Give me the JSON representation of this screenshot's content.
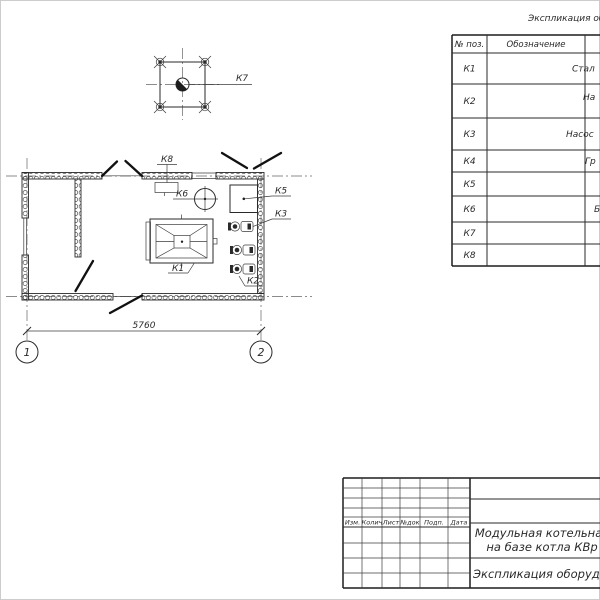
{
  "spec_table": {
    "title_fragment": "Экспликация обор",
    "col_pos": "№ поз.",
    "col_designation": "Обозначение",
    "rows": [
      {
        "pos": "К1",
        "name_fragment": "Стал"
      },
      {
        "pos": "К2",
        "name_fragment": "На"
      },
      {
        "pos": "К3",
        "name_fragment": "Насос"
      },
      {
        "pos": "К4",
        "name_fragment": "Гр"
      },
      {
        "pos": "К5",
        "name_fragment": ""
      },
      {
        "pos": "К6",
        "name_fragment": "Б"
      },
      {
        "pos": "К7",
        "name_fragment": ""
      },
      {
        "pos": "К8",
        "name_fragment": ""
      }
    ]
  },
  "plan": {
    "labels": {
      "k1": "К1",
      "k2": "К2",
      "k3": "К3",
      "k5": "К5",
      "k6": "К6",
      "k7": "К7",
      "k8": "К8"
    },
    "dimension_width": "5760",
    "axes": [
      "1",
      "2"
    ]
  },
  "title_block": {
    "columns": [
      "Изм.",
      "Колич",
      "Лист",
      "№док",
      "Подп.",
      "Дата"
    ],
    "title_line1": "Модульная котельная",
    "title_line2": "на базе котла КВр",
    "doc_name_fragment": "Экспликация оборудован"
  }
}
